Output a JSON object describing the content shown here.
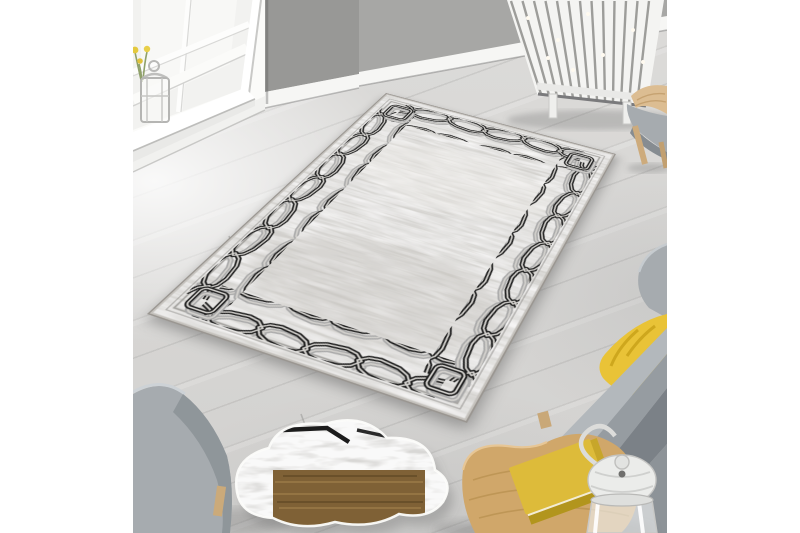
{
  "meta": {
    "description": "Lifestyle product photo of a light grey distressed-texture area rug with a black interlocking chain-link border, laid diagonally on pale wood flooring in a grey living room with a sash window, white column radiator, grey fabric armchairs, a mustard-yellow cushion, a cloud-shaped floor mirror, and a round oak side table holding a yellow book and a white hurricane lantern. White matte bands frame the photo left and right."
  },
  "palette": {
    "white": "#ffffff",
    "wall": "#a7a7a5",
    "wall_dark": "#989896",
    "baseboard": "#f6f6f4",
    "floor": "#d7d6d4",
    "rug_base": "#d3d1cd",
    "chain_black": "#1b1b1b",
    "chain_echo": "#a9a9a9",
    "chair_gray": "#a6abaf",
    "chair_gray_dark": "#8d9398",
    "pillow_yellow": "#e9c337",
    "wood_table": "#d0a76a",
    "wood_mirror": "#7f6136",
    "leg_wood": "#cbaa7a",
    "radiator": "#f4f4f2"
  },
  "scene": {
    "objects": [
      {
        "name": "area-rug",
        "label": "grey rug with black chain border"
      },
      {
        "name": "window",
        "label": "white sash window"
      },
      {
        "name": "sill-lantern",
        "label": "silver candle lantern on sill"
      },
      {
        "name": "sill-flowers",
        "label": "yellow flowers"
      },
      {
        "name": "radiator",
        "label": "white column radiator"
      },
      {
        "name": "armchair-top-right",
        "label": "grey chair with wood legs"
      },
      {
        "name": "armchair-right",
        "label": "grey armchair"
      },
      {
        "name": "cushion",
        "label": "yellow cushion"
      },
      {
        "name": "armchair-left",
        "label": "grey armchair"
      },
      {
        "name": "cloud-mirror",
        "label": "cloud-shaped floor mirror"
      },
      {
        "name": "side-table",
        "label": "round oak side table"
      },
      {
        "name": "book",
        "label": "yellow book"
      },
      {
        "name": "table-lantern",
        "label": "white hurricane lantern"
      }
    ]
  }
}
